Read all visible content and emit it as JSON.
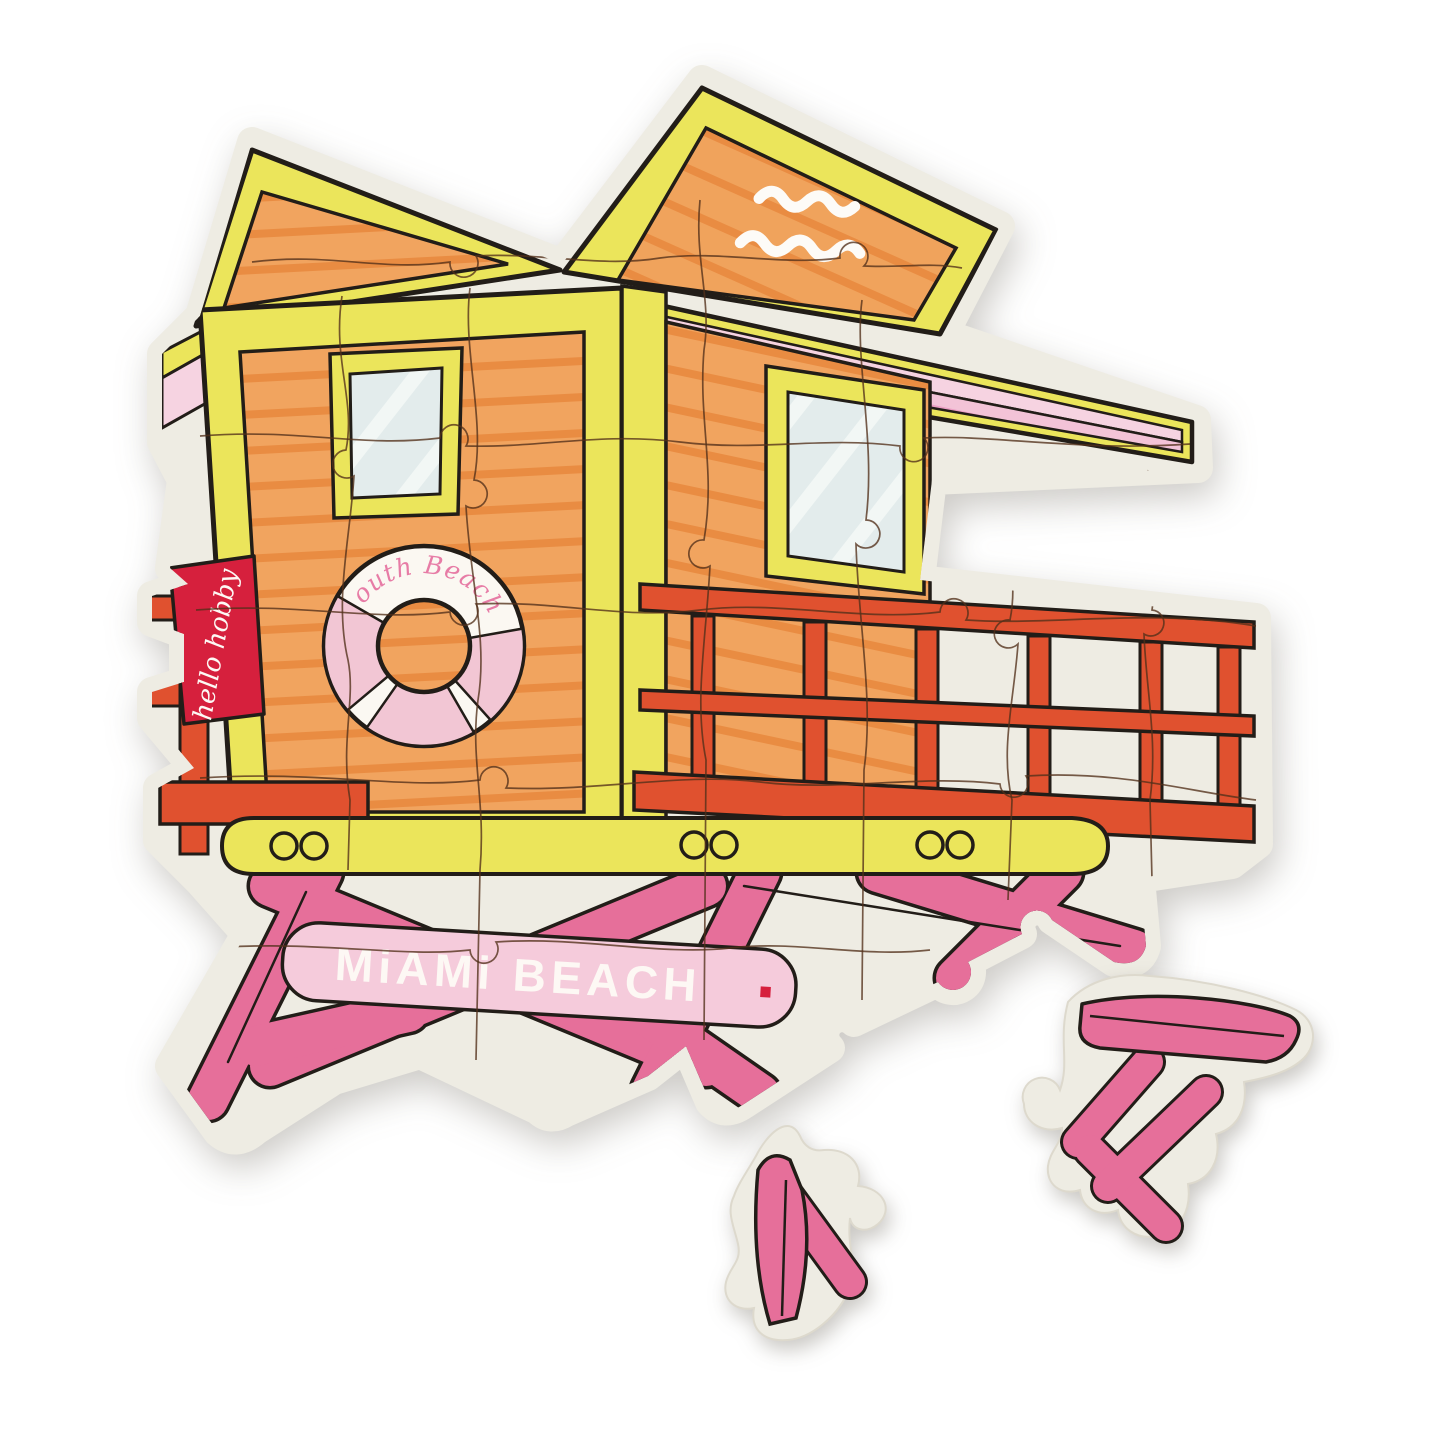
{
  "puzzle": {
    "assembled": {
      "flag_text": "hello hobby",
      "ring_text": "South Beach.",
      "sign_text": "MiAMi BEACH",
      "sign_period": "."
    },
    "loose_pieces": {
      "count": 2
    },
    "colors": {
      "board_cream": "#eeece3",
      "wood_orange": "#f1a45f",
      "wood_stripe": "#e98c42",
      "trim_yellow": "#ebe55b",
      "roof_pink": "#f3c3d7",
      "roof_pink_light": "#f6d3e1",
      "roof_stripe": "#eb9fc4",
      "railing_red": "#e0512f",
      "flag_red": "#d6203d",
      "leg_pink": "#e66f9a",
      "sign_pink": "#f5cbdb",
      "ring_pink": "#f2c6d4",
      "glass_blue": "#e3ecec",
      "outline": "#221d18"
    }
  }
}
